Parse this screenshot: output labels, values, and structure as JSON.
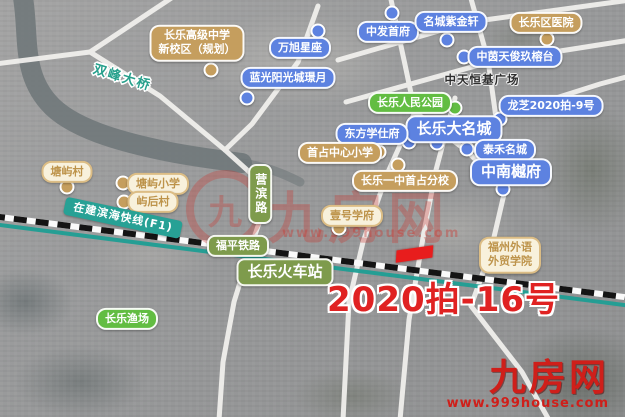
{
  "map": {
    "highlight": {
      "text": "2020拍-16号",
      "color": "#e02222"
    },
    "watermark_center": {
      "glyph": "九",
      "brand": "九房网",
      "url": "www.999house.com"
    },
    "watermark_corner": {
      "brand": "九房网",
      "url": "www.999house.com"
    },
    "colors": {
      "label_blue": "#5d82e0",
      "label_tan": "#c59e5e",
      "label_cream_bg": "#f8f1dc",
      "label_cream_text": "#bd934a",
      "label_green": "#62bd42",
      "road_label_green": "#7e9b4c",
      "metro_teal": "#27a195",
      "railway_black": "#141414",
      "parcel_red": "#e81d1d",
      "watermark_red": "#cf1f1a"
    },
    "labels": [
      {
        "name": "changle-senior-high-new-campus",
        "lines": [
          "长乐高级中学",
          "新校区（规划）"
        ],
        "type": "tan",
        "x": 197,
        "y": 43
      },
      {
        "name": "wanxu-xingzuo",
        "text": "万旭星座",
        "type": "blue",
        "x": 300,
        "y": 48
      },
      {
        "name": "languang-yangguangcheng-jingyue",
        "text": "蓝光阳光城璟月",
        "type": "blue",
        "x": 288,
        "y": 78
      },
      {
        "name": "zhongfa-shoufu",
        "text": "中发首府",
        "type": "blue",
        "x": 388,
        "y": 32
      },
      {
        "name": "mingcheng-zijinxuan",
        "text": "名城紫金轩",
        "type": "blue",
        "x": 451,
        "y": 22
      },
      {
        "name": "changle-district-hospital",
        "text": "长乐区医院",
        "type": "tan",
        "x": 546,
        "y": 23
      },
      {
        "name": "zhongyin-tianjun-jiurongtai",
        "text": "中茵天俊玖榕台",
        "type": "blue",
        "x": 515,
        "y": 57
      },
      {
        "name": "zhongtian-hengji-plaza",
        "text": "中天恒基广场",
        "type": "plain",
        "x": 482,
        "y": 80
      },
      {
        "name": "changle-peoples-park",
        "text": "长乐人民公园",
        "type": "green",
        "x": 410,
        "y": 103
      },
      {
        "name": "longzhi-2020-pai-9",
        "text": "龙芝2020拍-9号",
        "type": "blue",
        "x": 551,
        "y": 106
      },
      {
        "name": "changle-damingcheng",
        "text": "长乐大名城",
        "type": "blue lg",
        "x": 454,
        "y": 129
      },
      {
        "name": "dongfang-xueshifu",
        "text": "东方学仕府",
        "type": "blue",
        "x": 372,
        "y": 134
      },
      {
        "name": "taihe-mingcheng",
        "text": "泰禾名城",
        "type": "blue",
        "x": 505,
        "y": 150
      },
      {
        "name": "zhongnan-yuefu",
        "text": "中南樾府",
        "type": "blue lg",
        "x": 511,
        "y": 172
      },
      {
        "name": "shouzhan-central-primary",
        "text": "首占中心小学",
        "type": "tan",
        "x": 340,
        "y": 153
      },
      {
        "name": "changle-yizhong-shouzhan-branch",
        "text": "长乐一中首占分校",
        "type": "tan",
        "x": 405,
        "y": 181
      },
      {
        "name": "yihao-xuefu",
        "text": "壹号学府",
        "type": "cream",
        "x": 352,
        "y": 216
      },
      {
        "name": "tangyu-village",
        "text": "塘屿村",
        "type": "cream",
        "x": 67,
        "y": 172
      },
      {
        "name": "tangyu-primary",
        "text": "塘屿小学",
        "type": "cream",
        "x": 158,
        "y": 184
      },
      {
        "name": "yuhou-village",
        "text": "屿后村",
        "type": "cream",
        "x": 153,
        "y": 202
      },
      {
        "name": "yingbin-road",
        "text": "营滨路",
        "type": "road vert",
        "x": 260,
        "y": 194
      },
      {
        "name": "fuping-railway",
        "text": "福平铁路",
        "type": "road",
        "x": 238,
        "y": 246
      },
      {
        "name": "changle-railway-station",
        "text": "长乐火车站",
        "type": "road lg",
        "x": 285,
        "y": 272
      },
      {
        "name": "fuzhou-foreign-languages-college",
        "lines": [
          "福州外语",
          "外贸学院"
        ],
        "type": "cream",
        "x": 510,
        "y": 255
      },
      {
        "name": "changle-fishery",
        "text": "长乐渔场",
        "type": "green",
        "x": 127,
        "y": 319
      },
      {
        "name": "binhai-express-line",
        "text": "在建滨海快线(F1)",
        "type": "ribbon",
        "x": 123,
        "y": 218,
        "rotate": 12
      },
      {
        "name": "shuangfeng-bridge",
        "text": "双峰大桥",
        "type": "bridge",
        "x": 122,
        "y": 79,
        "rotate": 17
      }
    ],
    "dots": [
      {
        "for": "wanxu-xingzuo",
        "color": "blue",
        "x": 318,
        "y": 31
      },
      {
        "for": "zhongfa-shoufu",
        "color": "blue",
        "x": 392,
        "y": 13
      },
      {
        "for": "mingcheng-zijinxuan",
        "color": "blue",
        "x": 447,
        "y": 40
      },
      {
        "for": "zhongyin-tianjun-jiurongtai",
        "color": "blue",
        "x": 464,
        "y": 57
      },
      {
        "for": "languang-yangguangcheng-jingyue",
        "color": "blue",
        "x": 247,
        "y": 98
      },
      {
        "for": "longzhi-2020-pai-9",
        "color": "blue",
        "x": 500,
        "y": 119
      },
      {
        "for": "dongfang-xueshifu",
        "color": "blue",
        "x": 409,
        "y": 142
      },
      {
        "for": "changle-damingcheng",
        "color": "blue",
        "x": 437,
        "y": 143
      },
      {
        "for": "taihe-mingcheng",
        "color": "blue",
        "x": 467,
        "y": 149
      },
      {
        "for": "zhongnan-yuefu",
        "color": "blue",
        "x": 503,
        "y": 189
      },
      {
        "for": "changle-peoples-park",
        "color": "green",
        "x": 455,
        "y": 108
      },
      {
        "for": "changle-senior-high-new-campus",
        "color": "tan",
        "x": 211,
        "y": 70
      },
      {
        "for": "changle-district-hospital",
        "color": "tan",
        "x": 547,
        "y": 39
      },
      {
        "for": "shouzhan-central-primary",
        "color": "tan",
        "x": 379,
        "y": 152
      },
      {
        "for": "changle-yizhong-shouzhan-branch",
        "color": "tan",
        "x": 398,
        "y": 165
      },
      {
        "for": "tangyu-village",
        "color": "tan",
        "x": 67,
        "y": 187
      },
      {
        "for": "tangyu-primary",
        "color": "tan",
        "x": 123,
        "y": 183
      },
      {
        "for": "yuhou-village",
        "color": "tan",
        "x": 124,
        "y": 202
      },
      {
        "for": "yihao-xuefu",
        "color": "tan",
        "x": 339,
        "y": 228
      }
    ]
  }
}
